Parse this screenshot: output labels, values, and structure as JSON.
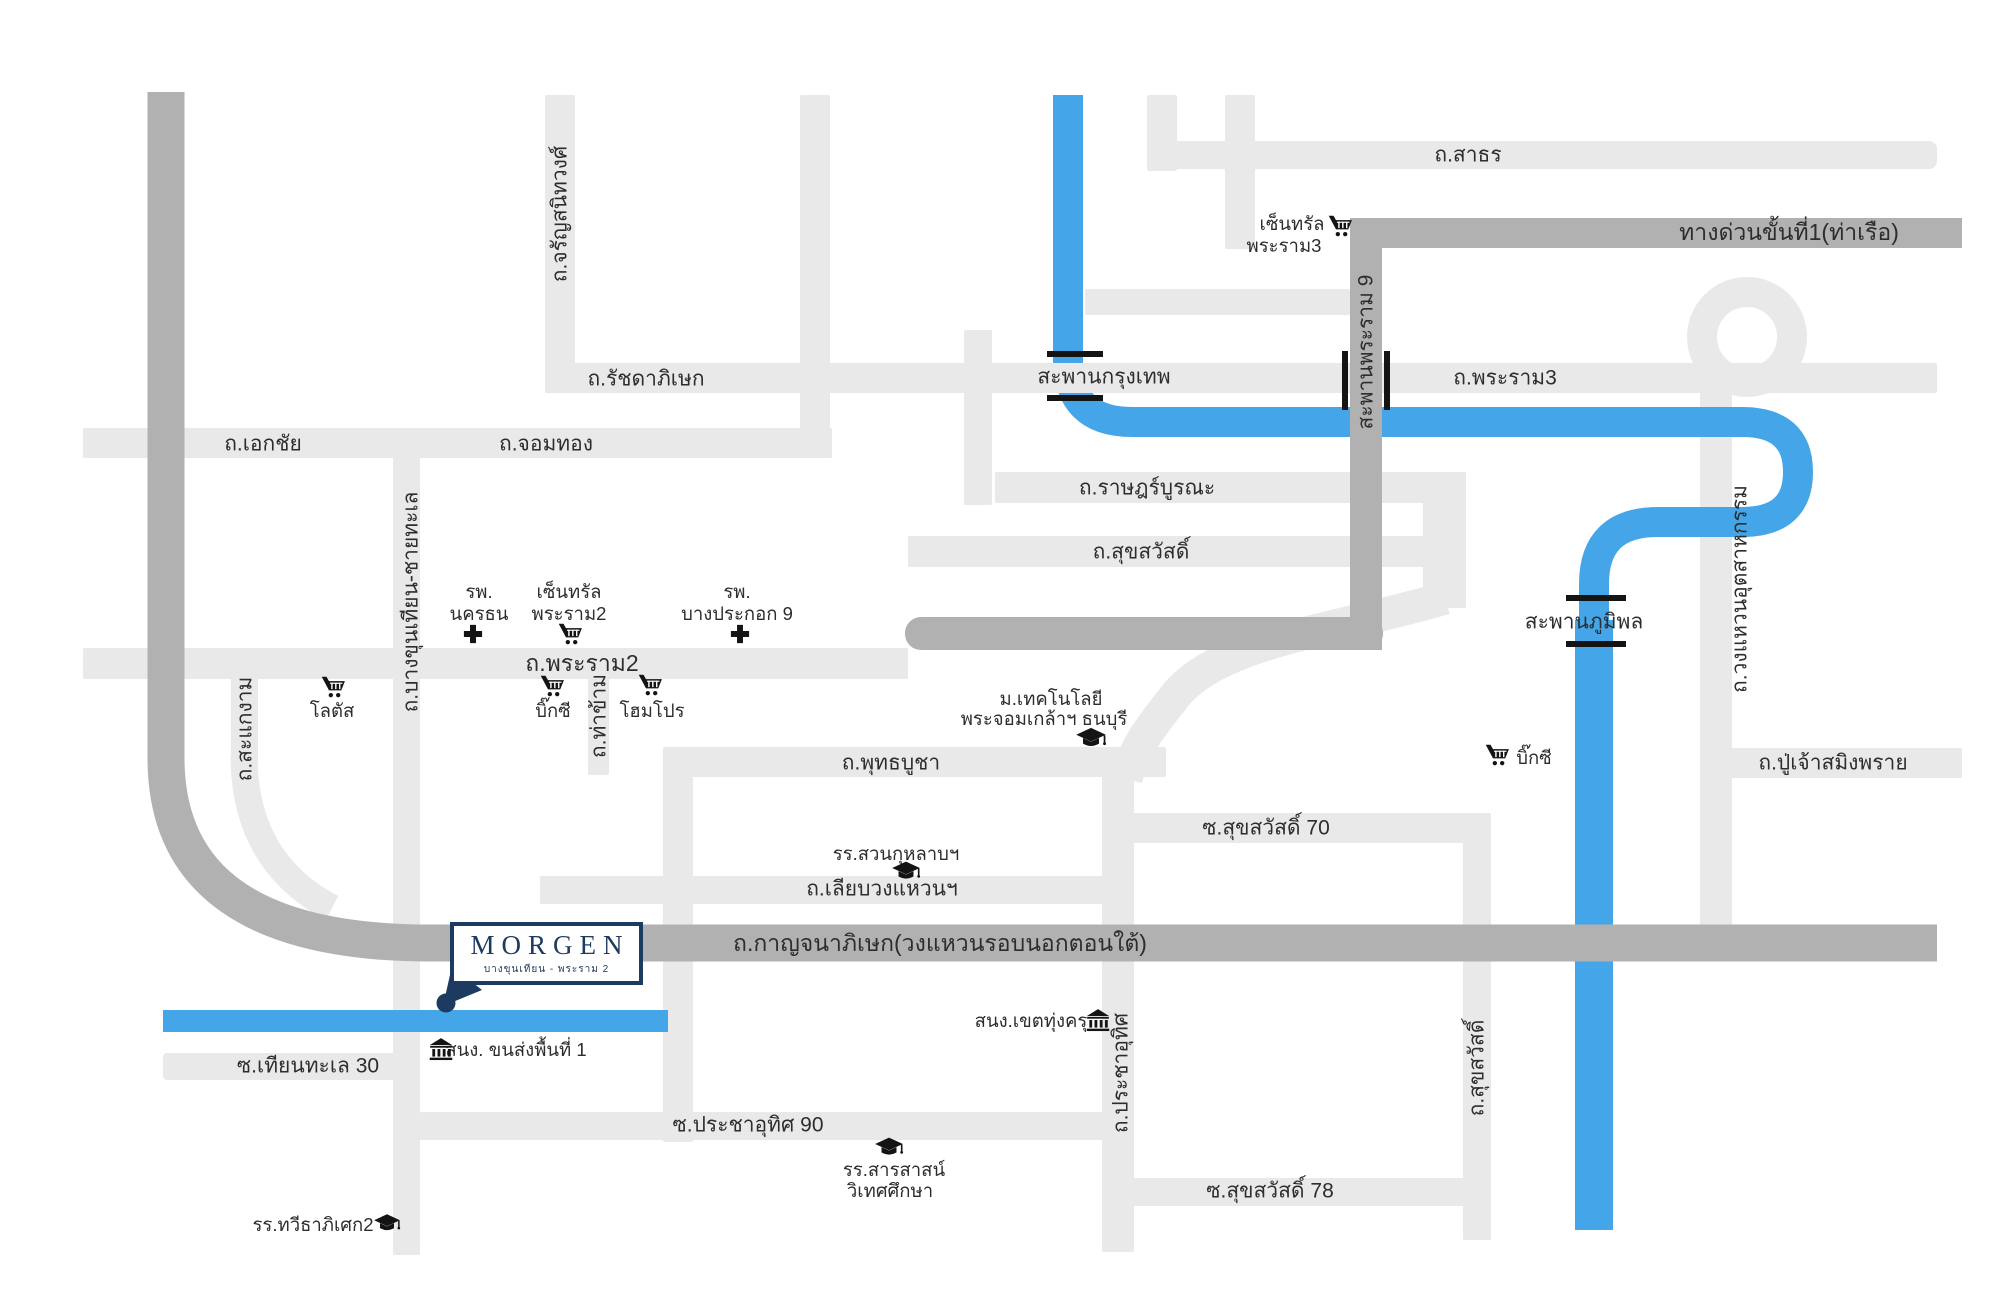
{
  "project": {
    "name": "MORGEN",
    "subtitle": "บางขุนเทียน - พระราม 2"
  },
  "colors": {
    "road": "#e9e9e9",
    "expressway": "#b1b1b1",
    "water": "#45a5e9",
    "text": "#2d2d2d",
    "navy": "#1d3b60"
  },
  "labels": [
    {
      "name": "sathorn",
      "text": "ถ.สาธร",
      "x": 1468,
      "y": 155,
      "cls": "road"
    },
    {
      "name": "expressway-1-port",
      "text": "ทางด่วนขั้นที่1(ท่าเรือ)",
      "x": 1789,
      "y": 233,
      "cls": "xl"
    },
    {
      "name": "ratchadaphisek",
      "text": "ถ.รัชดาภิเษก",
      "x": 646,
      "y": 379,
      "cls": "road"
    },
    {
      "name": "saphan-krungthep",
      "text": "สะพานกรุงเทพ",
      "x": 1104,
      "y": 377,
      "cls": "road"
    },
    {
      "name": "rama3",
      "text": "ถ.พระราม3",
      "x": 1505,
      "y": 378,
      "cls": "road"
    },
    {
      "name": "ekachai",
      "text": "ถ.เอกชัย",
      "x": 263,
      "y": 444,
      "cls": "road"
    },
    {
      "name": "chomthong",
      "text": "ถ.จอมทอง",
      "x": 546,
      "y": 444,
      "cls": "road"
    },
    {
      "name": "ratburana",
      "text": "ถ.ราษฎร์บูรณะ",
      "x": 1147,
      "y": 488,
      "cls": "road"
    },
    {
      "name": "suksawat",
      "text": "ถ.สุขสวัสดิ์",
      "x": 1141,
      "y": 552,
      "cls": "road"
    },
    {
      "name": "rama2",
      "text": "ถ.พระราม2",
      "x": 582,
      "y": 664,
      "cls": "xl"
    },
    {
      "name": "phutthabucha",
      "text": "ถ.พุทธบูชา",
      "x": 891,
      "y": 763,
      "cls": "road"
    },
    {
      "name": "puchao-samingphrai",
      "text": "ถ.ปู่เจ้าสมิงพราย",
      "x": 1833,
      "y": 763,
      "cls": "road"
    },
    {
      "name": "suksawat-70",
      "text": "ซ.สุขสวัสดิ์ 70",
      "x": 1266,
      "y": 828,
      "cls": "road"
    },
    {
      "name": "liap-wongwaen",
      "text": "ถ.เลียบวงแหวนฯ",
      "x": 882,
      "y": 889,
      "cls": "road"
    },
    {
      "name": "kanchanaphisek",
      "text": "ถ.กาญจนาภิเษก(วงแหวนรอบนอกตอนใต้)",
      "x": 940,
      "y": 944,
      "cls": "xl"
    },
    {
      "name": "thianthale-30",
      "text": "ซ.เทียนทะเล 30",
      "x": 308,
      "y": 1066,
      "cls": "road"
    },
    {
      "name": "prachauthit-90",
      "text": "ซ.ประชาอุทิศ 90",
      "x": 748,
      "y": 1125,
      "cls": "road"
    },
    {
      "name": "suksawat-78",
      "text": "ซ.สุขสวัสดิ์ 78",
      "x": 1270,
      "y": 1191,
      "cls": "road"
    },
    {
      "name": "saphan-bhumibol",
      "text": "สะพานภูมิพล",
      "x": 1584,
      "y": 622,
      "cls": "road"
    },
    {
      "name": "charansanitwong",
      "text": "ถ.จรัญสนิทวงศ์",
      "x": 560,
      "y": 214,
      "rot": true,
      "cls": "road"
    },
    {
      "name": "bangkhunthian-chaithale",
      "text": "ถ.บางขุนเทียน-ชายทะเล",
      "x": 411,
      "y": 602,
      "rot": true,
      "cls": "road"
    },
    {
      "name": "sakaengam",
      "text": "ถ.สะแกงาม",
      "x": 245,
      "y": 729,
      "rot": true,
      "cls": "road"
    },
    {
      "name": "thakham",
      "text": "ถ.ท่าข้าม",
      "x": 599,
      "y": 716,
      "rot": true,
      "cls": "road"
    },
    {
      "name": "saphan-rama9",
      "text": "สะพานพระราม 9",
      "x": 1366,
      "y": 352,
      "rot": true,
      "cls": "road"
    },
    {
      "name": "prachauthit",
      "text": "ถ.ประชาอุทิศ",
      "x": 1121,
      "y": 1073,
      "rot": true,
      "cls": "road"
    },
    {
      "name": "suksawat-vertical",
      "text": "ถ.สุขสวัสดิ์",
      "x": 1477,
      "y": 1068,
      "rot": true,
      "cls": "road"
    },
    {
      "name": "wongwaen-utsahakam",
      "text": "ถ.วงแหวนอุตสาหกรรม",
      "x": 1740,
      "y": 589,
      "rot": true,
      "cls": "road"
    },
    {
      "name": "central-rama3-line1",
      "text": "เซ็นทรัล",
      "x": 1292,
      "y": 224,
      "cls": "poi"
    },
    {
      "name": "central-rama3-line2",
      "text": "พระราม3",
      "x": 1284,
      "y": 246,
      "cls": "poi"
    },
    {
      "name": "hospital-nakhonthon-line1",
      "text": "รพ.",
      "x": 479,
      "y": 592,
      "cls": "poi"
    },
    {
      "name": "hospital-nakhonthon-line2",
      "text": "นครธน",
      "x": 479,
      "y": 614,
      "cls": "poi"
    },
    {
      "name": "central-rama2-line1",
      "text": "เซ็นทรัล",
      "x": 569,
      "y": 592,
      "cls": "poi"
    },
    {
      "name": "central-rama2-line2",
      "text": "พระราม2",
      "x": 569,
      "y": 614,
      "cls": "poi"
    },
    {
      "name": "hospital-bangpakok9-line1",
      "text": "รพ.",
      "x": 737,
      "y": 592,
      "cls": "poi"
    },
    {
      "name": "hospital-bangpakok9-line2",
      "text": "บางประกอก 9",
      "x": 737,
      "y": 614,
      "cls": "poi"
    },
    {
      "name": "lotus",
      "text": "โลตัส",
      "x": 332,
      "y": 711,
      "cls": "poi"
    },
    {
      "name": "bigc-west",
      "text": "บิ๊กซี",
      "x": 553,
      "y": 711,
      "cls": "poi"
    },
    {
      "name": "homepro",
      "text": "โฮมโปร",
      "x": 652,
      "y": 711,
      "cls": "poi"
    },
    {
      "name": "kmutt-line1",
      "text": "ม.เทคโนโลยี",
      "x": 1051,
      "y": 699,
      "cls": "poi"
    },
    {
      "name": "kmutt-line2",
      "text": "พระจอมเกล้าฯ ธนบุรี",
      "x": 1044,
      "y": 719,
      "cls": "poi"
    },
    {
      "name": "bigc-east",
      "text": "บิ๊กซี",
      "x": 1534,
      "y": 758,
      "cls": "poi"
    },
    {
      "name": "suankularb-school",
      "text": "รร.สวนกุหลาบฯ",
      "x": 896,
      "y": 854,
      "cls": "poi"
    },
    {
      "name": "thungkhru-district-office",
      "text": "สนง.เขตทุ่งครุ",
      "x": 1031,
      "y": 1021,
      "cls": "poi"
    },
    {
      "name": "transport-office-area1",
      "text": "สนง. ขนส่งพื้นที่ 1",
      "x": 516,
      "y": 1050,
      "cls": "poi"
    },
    {
      "name": "sarasas-school-line1",
      "text": "รร.สารสาสน์",
      "x": 894,
      "y": 1170,
      "cls": "poi"
    },
    {
      "name": "sarasas-school-line2",
      "text": "วิเทศศึกษา",
      "x": 890,
      "y": 1191,
      "cls": "poi"
    },
    {
      "name": "taweethapisek2-school",
      "text": "รร.ทวีธาภิเศก2",
      "x": 313,
      "y": 1225,
      "cls": "poi"
    }
  ],
  "icons": [
    {
      "name": "central-rama3-cart",
      "glyph": "cart",
      "x": 1340,
      "y": 227,
      "size": 26
    },
    {
      "name": "nakhonthon-cross",
      "glyph": "cross",
      "x": 473,
      "y": 634,
      "size": 21
    },
    {
      "name": "central-rama2-cart",
      "glyph": "cart",
      "x": 570,
      "y": 635,
      "size": 26
    },
    {
      "name": "bangpakok9-cross",
      "glyph": "cross",
      "x": 740,
      "y": 634,
      "size": 21
    },
    {
      "name": "lotus-cart",
      "glyph": "cart",
      "x": 333,
      "y": 688,
      "size": 26
    },
    {
      "name": "bigc-west-cart",
      "glyph": "cart",
      "x": 552,
      "y": 687,
      "size": 26
    },
    {
      "name": "homepro-cart",
      "glyph": "cart",
      "x": 650,
      "y": 686,
      "size": 26
    },
    {
      "name": "kmutt-gradcap",
      "glyph": "cap",
      "x": 1091,
      "y": 739,
      "size": 32
    },
    {
      "name": "bigc-east-cart",
      "glyph": "cart",
      "x": 1497,
      "y": 756,
      "size": 26
    },
    {
      "name": "suankularb-gradcap",
      "glyph": "cap",
      "x": 906,
      "y": 872,
      "size": 30
    },
    {
      "name": "thungkhru-building",
      "glyph": "building",
      "x": 1098,
      "y": 1020,
      "size": 26
    },
    {
      "name": "transport-building",
      "glyph": "building",
      "x": 441,
      "y": 1049,
      "size": 26
    },
    {
      "name": "sarasas-gradcap",
      "glyph": "cap",
      "x": 889,
      "y": 1148,
      "size": 30
    },
    {
      "name": "taweethapisek2-gradcap",
      "glyph": "cap",
      "x": 387,
      "y": 1224,
      "size": 28
    }
  ]
}
